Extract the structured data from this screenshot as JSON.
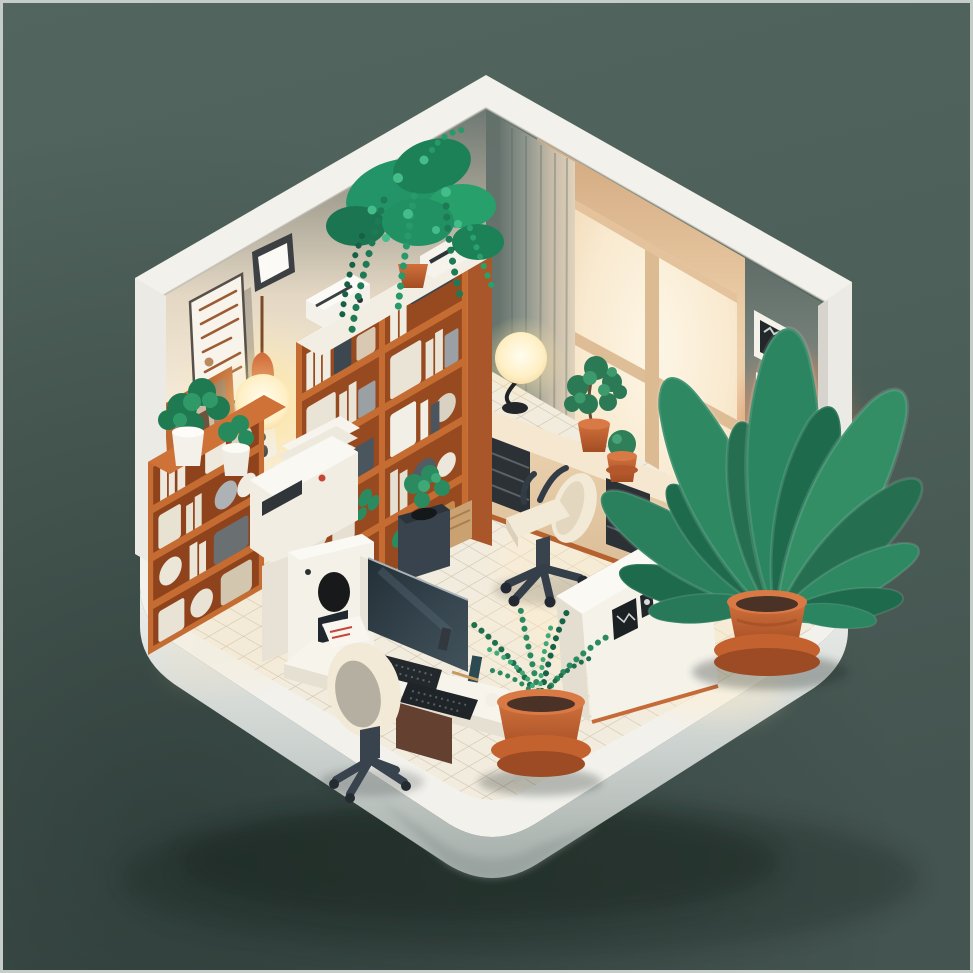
{
  "meta": {
    "type": "3d-isometric-illustration",
    "subject": "Cozy isometric home office room diorama with orange bookshelves, plants, desk and warm window light",
    "canvas": {
      "width": 973,
      "height": 973
    }
  },
  "palette": {
    "background": "#4e605a",
    "background-deep": "#3d4c47",
    "frame-border": "#c6ccc8",
    "wall-white": "#f2f1ec",
    "wall-endcap": "#eceae4",
    "wall-cream": "#f3e8d6",
    "wall-shadow": "#64716c",
    "wall-gray": "#97a09a",
    "wall-peach": "#ecd0ab",
    "wall-orange-glow": "#d8895b",
    "window-glow": "#fbf2e0",
    "window-frame": "#dcba92",
    "curtain-lit": "#ddd1ba",
    "curtain-shadow": "#717e78",
    "shelf-orange": "#c56c33",
    "shelf-orange-dark": "#a9572a",
    "shelf-cavity": "#97491f",
    "floor-tile": "#f2ecdf",
    "floor-grout": "#cdc0a8",
    "platform-light": "#eceeec",
    "platform-dark": "#a9b1ad",
    "furniture-white": "#f5f2ea",
    "furniture-shade": "#e0dacb",
    "drawer-dark": "#2c3136",
    "chair-cream": "#f2e9d7",
    "chair-base": "#39434e",
    "monitor-screen": "#2b3740",
    "leaf-dark": "#1e6a4d",
    "leaf-mid": "#2e8862",
    "leaf-light": "#3fa877",
    "vine-green": "#27996a",
    "pot-terracotta": "#c4622f",
    "pot-terracotta-dark": "#9c4b24",
    "pot-terracotta-light": "#d97a46",
    "lamp-glow": "#fff3d2",
    "lamp-cap": "#cd5f2e",
    "ground-shadow": "#15201c"
  },
  "scene": {
    "objects": [
      {
        "id": "room-platform",
        "desc": "rounded white display base the room sits on"
      },
      {
        "id": "left-wall",
        "desc": "interior cream wall, shaded gray-green near the top corner"
      },
      {
        "id": "right-wall",
        "desc": "back wall with bright window, peach light and gray corner"
      },
      {
        "id": "window",
        "desc": "large glowing window with tan mullion bars"
      },
      {
        "id": "curtain",
        "desc": "floor-length pleated curtain, beige lit edge and shadowed side"
      },
      {
        "id": "certificate-frame",
        "desc": "framed document with rust-colored text lines on left wall"
      },
      {
        "id": "wall-tablet-frame",
        "desc": "small dark-framed blank picture high on left wall"
      },
      {
        "id": "pendant-lamp",
        "desc": "hanging lamp with orange cap and glowing warm bulb"
      },
      {
        "id": "wall-mirror",
        "desc": "orange-framed mirror art behind the shelf plants"
      },
      {
        "id": "wall-art-print",
        "desc": "small monochrome art card on left wall"
      },
      {
        "id": "wall-frame-photo",
        "desc": "small white frame with dark photo on right gray wall"
      },
      {
        "id": "wall-frame-lines",
        "desc": "small white frame with green scribble lines on right gray wall"
      },
      {
        "id": "bookshelf",
        "desc": "tall orange double-bay bookcase filled with white books, boxes and jars"
      },
      {
        "id": "hanging-plant",
        "desc": "trailing pothos cascading from a pot atop the bookshelf"
      },
      {
        "id": "shelf-printer",
        "desc": "white printer and storage boxes on bookshelf top"
      },
      {
        "id": "etagere",
        "desc": "small orange open shelf with baskets, books and two potted plants"
      },
      {
        "id": "copier",
        "desc": "white copier machine stacked with paper beside the desk"
      },
      {
        "id": "pc-cabinet",
        "desc": "white tower cabinet with dark speaker oval and mini screen"
      },
      {
        "id": "credenza",
        "desc": "beige sideboard along back wall with two dark drawer stacks"
      },
      {
        "id": "credenza-lamp",
        "desc": "round glowing desk lamp on the credenza"
      },
      {
        "id": "credenza-plant-bush",
        "desc": "leafy plant in terracotta pot on credenza"
      },
      {
        "id": "credenza-plant-succulent",
        "desc": "round succulent in small terracotta pot on credenza"
      },
      {
        "id": "trash-bin",
        "desc": "dark slate waste bin with plant and basket beside bookshelf"
      },
      {
        "id": "lounge-chair",
        "desc": "cream swivel lounge chair with dark five-star base, room center"
      },
      {
        "id": "desk",
        "desc": "white work desk with monitor, two dark keyboards and papers"
      },
      {
        "id": "desk-monitor",
        "desc": "wide dark monitor standing on the desk"
      },
      {
        "id": "desk-chair",
        "desc": "cream task chair with gray cushion at the desk"
      },
      {
        "id": "sideboard",
        "desc": "white low cabinet with three small dark pictures on its front"
      },
      {
        "id": "big-plant",
        "desc": "large paddle-leaf plant in double terracotta pot by right wall"
      },
      {
        "id": "foreground-plant",
        "desc": "feathery plant in ringed terracotta pot at front"
      },
      {
        "id": "tiled-floor",
        "desc": "cream isometric tile floor with warm window light pool"
      }
    ]
  }
}
